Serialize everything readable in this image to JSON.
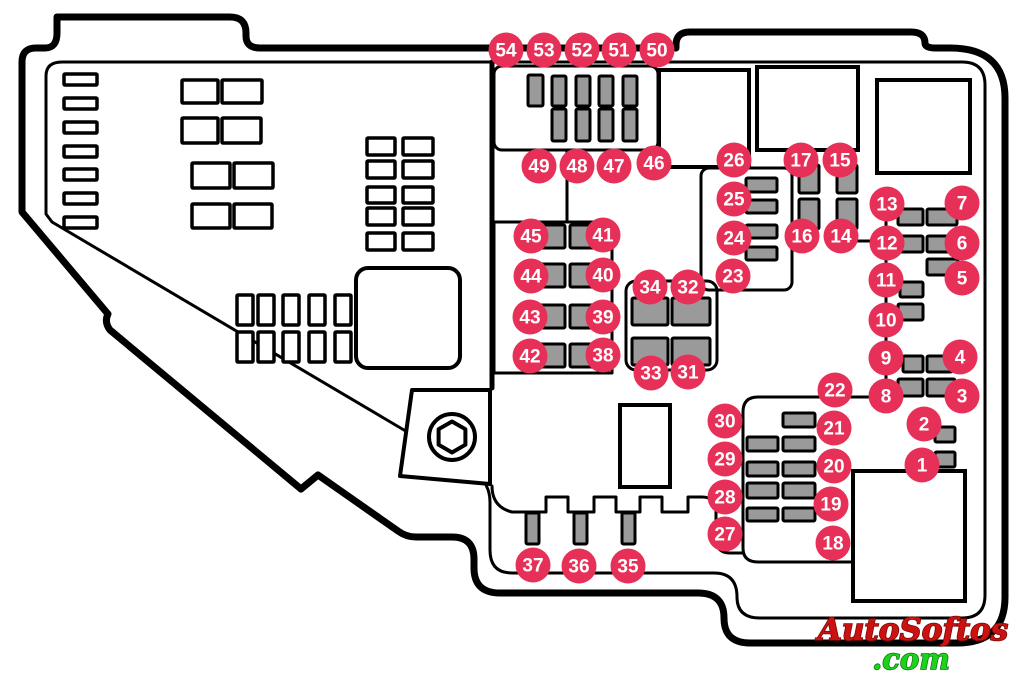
{
  "diagram": {
    "title": "Engine compartment fuse box diagram",
    "colors": {
      "callout_fill": "#e73058",
      "callout_text": "#ffffff",
      "fuse_fill": "#9a9a9a",
      "line": "#000000",
      "background": "#ffffff",
      "watermark_primary": "#cc1111",
      "watermark_secondary": "#1dd21d"
    },
    "watermark": {
      "line1": "AutoSoftos",
      "line2": ".com"
    },
    "callouts": [
      {
        "n": "54",
        "x": 506,
        "y": 50
      },
      {
        "n": "53",
        "x": 544,
        "y": 50
      },
      {
        "n": "52",
        "x": 582,
        "y": 50
      },
      {
        "n": "51",
        "x": 619,
        "y": 50
      },
      {
        "n": "50",
        "x": 657,
        "y": 50
      },
      {
        "n": "49",
        "x": 539,
        "y": 166
      },
      {
        "n": "48",
        "x": 577,
        "y": 166
      },
      {
        "n": "47",
        "x": 614,
        "y": 166
      },
      {
        "n": "46",
        "x": 654,
        "y": 163
      },
      {
        "n": "26",
        "x": 734,
        "y": 160
      },
      {
        "n": "17",
        "x": 801,
        "y": 160
      },
      {
        "n": "15",
        "x": 840,
        "y": 160
      },
      {
        "n": "25",
        "x": 734,
        "y": 199
      },
      {
        "n": "24",
        "x": 734,
        "y": 238
      },
      {
        "n": "23",
        "x": 733,
        "y": 276
      },
      {
        "n": "16",
        "x": 802,
        "y": 236
      },
      {
        "n": "14",
        "x": 841,
        "y": 236
      },
      {
        "n": "13",
        "x": 887,
        "y": 204
      },
      {
        "n": "7",
        "x": 962,
        "y": 203
      },
      {
        "n": "12",
        "x": 887,
        "y": 243
      },
      {
        "n": "6",
        "x": 962,
        "y": 243
      },
      {
        "n": "11",
        "x": 886,
        "y": 280
      },
      {
        "n": "5",
        "x": 962,
        "y": 278
      },
      {
        "n": "10",
        "x": 886,
        "y": 320
      },
      {
        "n": "9",
        "x": 886,
        "y": 358
      },
      {
        "n": "4",
        "x": 960,
        "y": 357
      },
      {
        "n": "8",
        "x": 886,
        "y": 396
      },
      {
        "n": "3",
        "x": 962,
        "y": 396
      },
      {
        "n": "22",
        "x": 835,
        "y": 390
      },
      {
        "n": "2",
        "x": 924,
        "y": 424
      },
      {
        "n": "1",
        "x": 922,
        "y": 465
      },
      {
        "n": "45",
        "x": 531,
        "y": 236
      },
      {
        "n": "41",
        "x": 603,
        "y": 235
      },
      {
        "n": "44",
        "x": 531,
        "y": 276
      },
      {
        "n": "40",
        "x": 603,
        "y": 275
      },
      {
        "n": "43",
        "x": 530,
        "y": 317
      },
      {
        "n": "39",
        "x": 603,
        "y": 317
      },
      {
        "n": "42",
        "x": 530,
        "y": 356
      },
      {
        "n": "38",
        "x": 603,
        "y": 355
      },
      {
        "n": "34",
        "x": 650,
        "y": 287
      },
      {
        "n": "32",
        "x": 688,
        "y": 287
      },
      {
        "n": "33",
        "x": 651,
        "y": 373
      },
      {
        "n": "31",
        "x": 688,
        "y": 372
      },
      {
        "n": "30",
        "x": 725,
        "y": 421
      },
      {
        "n": "29",
        "x": 725,
        "y": 459
      },
      {
        "n": "28",
        "x": 725,
        "y": 497
      },
      {
        "n": "27",
        "x": 725,
        "y": 534
      },
      {
        "n": "21",
        "x": 834,
        "y": 428
      },
      {
        "n": "20",
        "x": 834,
        "y": 466
      },
      {
        "n": "19",
        "x": 831,
        "y": 504
      },
      {
        "n": "18",
        "x": 833,
        "y": 543
      },
      {
        "n": "37",
        "x": 533,
        "y": 565
      },
      {
        "n": "36",
        "x": 579,
        "y": 566
      },
      {
        "n": "35",
        "x": 628,
        "y": 566
      }
    ],
    "gray_fuses": [
      [
        528,
        75,
        15,
        31
      ],
      [
        552,
        76,
        14,
        30
      ],
      [
        576,
        76,
        14,
        30
      ],
      [
        599,
        76,
        14,
        30
      ],
      [
        623,
        76,
        14,
        30
      ],
      [
        552,
        109,
        14,
        32
      ],
      [
        576,
        109,
        14,
        32
      ],
      [
        599,
        109,
        14,
        32
      ],
      [
        623,
        109,
        14,
        32
      ],
      [
        746,
        178,
        31,
        14
      ],
      [
        746,
        200,
        31,
        13
      ],
      [
        746,
        225,
        31,
        13
      ],
      [
        746,
        247,
        31,
        13
      ],
      [
        799,
        165,
        20,
        28
      ],
      [
        837,
        165,
        20,
        28
      ],
      [
        799,
        199,
        20,
        30
      ],
      [
        837,
        199,
        20,
        30
      ],
      [
        898,
        209,
        25,
        16
      ],
      [
        927,
        209,
        30,
        16
      ],
      [
        898,
        236,
        25,
        16
      ],
      [
        927,
        236,
        30,
        16
      ],
      [
        927,
        259,
        31,
        16
      ],
      [
        900,
        282,
        23,
        15
      ],
      [
        898,
        304,
        25,
        16
      ],
      [
        903,
        356,
        20,
        16
      ],
      [
        927,
        356,
        25,
        16
      ],
      [
        898,
        379,
        25,
        17
      ],
      [
        927,
        379,
        28,
        17
      ],
      [
        935,
        427,
        20,
        15
      ],
      [
        935,
        452,
        20,
        15
      ],
      [
        533,
        225,
        32,
        23
      ],
      [
        570,
        225,
        32,
        23
      ],
      [
        533,
        264,
        32,
        23
      ],
      [
        570,
        264,
        32,
        23
      ],
      [
        533,
        305,
        32,
        23
      ],
      [
        570,
        305,
        32,
        23
      ],
      [
        533,
        344,
        32,
        23
      ],
      [
        570,
        344,
        32,
        23
      ],
      [
        632,
        298,
        36,
        27
      ],
      [
        672,
        298,
        38,
        27
      ],
      [
        632,
        338,
        36,
        27
      ],
      [
        672,
        338,
        38,
        27
      ],
      [
        783,
        413,
        32,
        14
      ],
      [
        747,
        437,
        31,
        14
      ],
      [
        783,
        437,
        32,
        14
      ],
      [
        747,
        462,
        31,
        14
      ],
      [
        783,
        462,
        32,
        14
      ],
      [
        747,
        483,
        31,
        15
      ],
      [
        783,
        483,
        32,
        15
      ],
      [
        747,
        508,
        31,
        13
      ],
      [
        783,
        508,
        32,
        13
      ],
      [
        526,
        513,
        13,
        31
      ],
      [
        574,
        513,
        13,
        31
      ],
      [
        622,
        513,
        13,
        31
      ]
    ],
    "white_fixtures": [
      [
        64,
        74,
        33,
        11
      ],
      [
        64,
        98,
        33,
        11
      ],
      [
        64,
        122,
        33,
        11
      ],
      [
        64,
        146,
        33,
        11
      ],
      [
        64,
        169,
        33,
        11
      ],
      [
        64,
        193,
        33,
        11
      ],
      [
        64,
        217,
        33,
        11
      ],
      [
        182,
        80,
        36,
        23
      ],
      [
        222,
        80,
        40,
        23
      ],
      [
        182,
        118,
        36,
        25
      ],
      [
        222,
        118,
        39,
        25
      ],
      [
        192,
        163,
        38,
        25
      ],
      [
        234,
        163,
        39,
        25
      ],
      [
        192,
        204,
        38,
        24
      ],
      [
        234,
        204,
        38,
        24
      ],
      [
        367,
        138,
        28,
        17
      ],
      [
        403,
        138,
        30,
        17
      ],
      [
        367,
        161,
        28,
        17
      ],
      [
        403,
        161,
        30,
        17
      ],
      [
        367,
        187,
        28,
        16
      ],
      [
        403,
        187,
        30,
        16
      ],
      [
        367,
        208,
        28,
        17
      ],
      [
        403,
        208,
        30,
        17
      ],
      [
        367,
        233,
        28,
        17
      ],
      [
        403,
        233,
        30,
        17
      ],
      [
        237,
        295,
        16,
        30
      ],
      [
        258,
        295,
        16,
        30
      ],
      [
        283,
        295,
        16,
        30
      ],
      [
        309,
        295,
        16,
        30
      ],
      [
        335,
        295,
        16,
        30
      ],
      [
        237,
        332,
        16,
        30
      ],
      [
        258,
        332,
        16,
        30
      ],
      [
        283,
        332,
        16,
        30
      ],
      [
        309,
        332,
        16,
        30
      ],
      [
        335,
        332,
        16,
        30
      ]
    ],
    "relay_boxes": [
      [
        659,
        70,
        90,
        97
      ],
      [
        757,
        67,
        101,
        83
      ],
      [
        877,
        80,
        93,
        93
      ],
      [
        620,
        405,
        50,
        82
      ],
      [
        853,
        471,
        112,
        130
      ]
    ],
    "rounded_square": [
      356,
      268,
      104,
      100
    ]
  }
}
